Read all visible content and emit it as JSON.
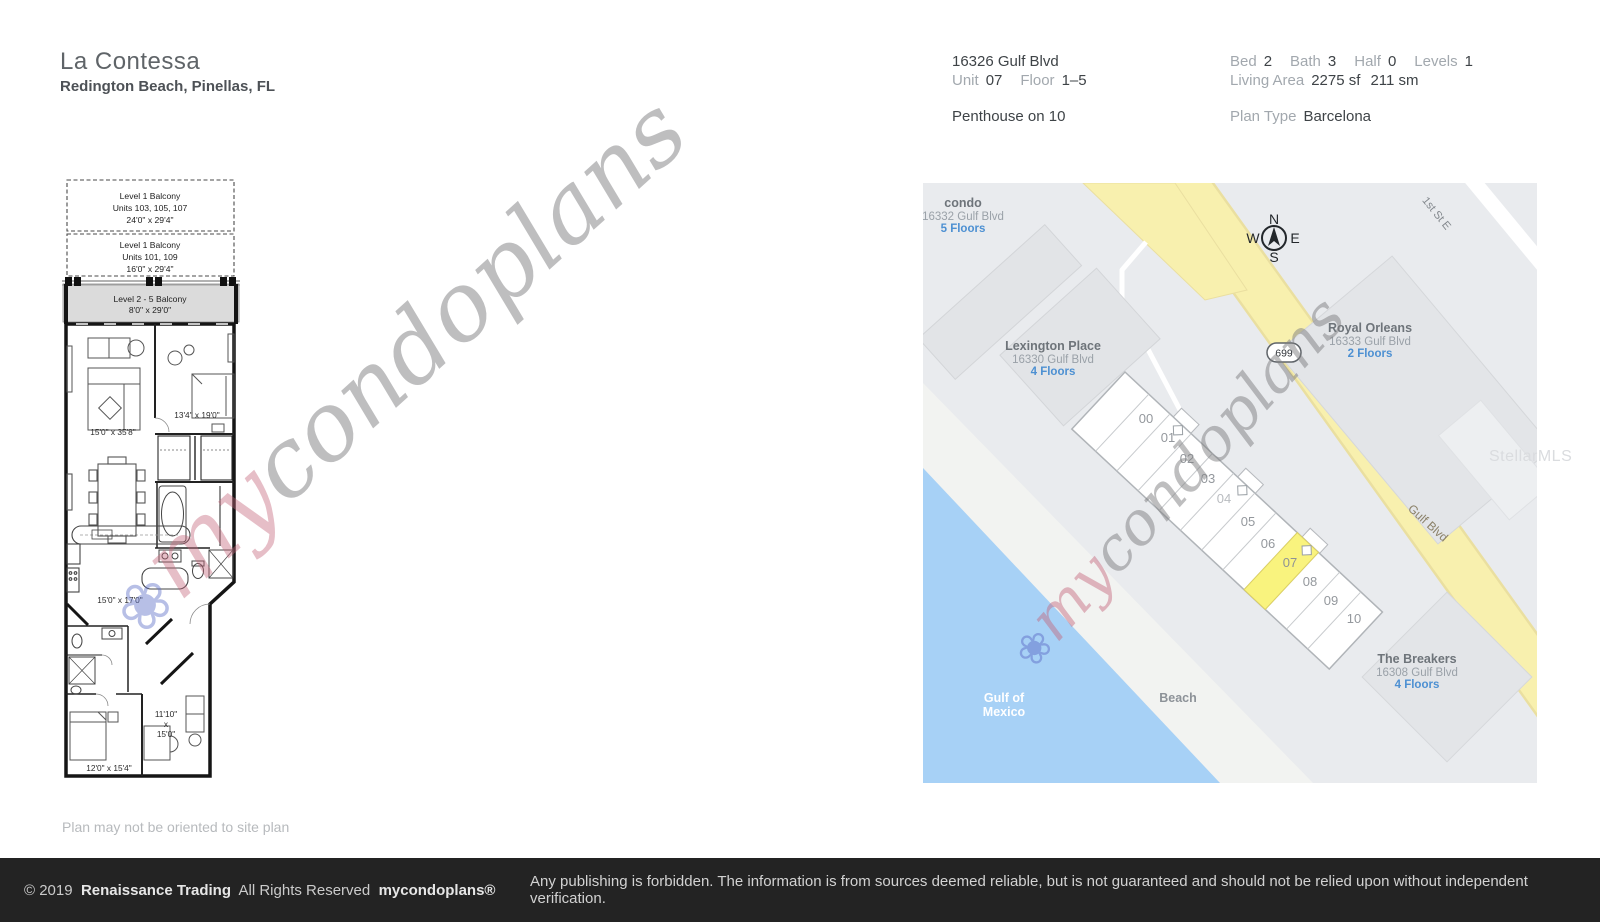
{
  "header": {
    "title": "La Contessa",
    "subtitle": "Redington Beach, Pinellas, FL",
    "address": "16326 Gulf Blvd",
    "unit_label": "Unit",
    "unit": "07",
    "floor_label": "Floor",
    "floor": "1–5",
    "penthouse": "Penthouse on 10",
    "bed_label": "Bed",
    "bed": "2",
    "bath_label": "Bath",
    "bath": "3",
    "half_label": "Half",
    "half": "0",
    "levels_label": "Levels",
    "levels": "1",
    "living_area_label": "Living Area",
    "living_area_sf": "2275 sf",
    "living_area_sm": "211 sm",
    "plan_type_label": "Plan Type",
    "plan_type": "Barcelona"
  },
  "floorplan": {
    "balcony1": {
      "l1": "Level 1 Balcony",
      "l2": "Units 103, 105, 107",
      "l3": "24'0\" x 29'4\""
    },
    "balcony2": {
      "l1": "Level 1 Balcony",
      "l2": "Units 101, 109",
      "l3": "16'0\" x 29'4\""
    },
    "balcony25": {
      "l1": "Level 2 - 5 Balcony",
      "l2": "8'0\" x 29'0\""
    },
    "living": "15'0\" x 35'8\"",
    "master": "13'4\" x 19'0\"",
    "kitchen": "15'0\" x 17'0\"",
    "den": [
      "11'10\"",
      "x",
      "15'0\""
    ],
    "bed2": "12'0\" x 15'4\"",
    "note": "Plan may not be oriented to site plan"
  },
  "map": {
    "buildings": [
      {
        "name": "condo",
        "address": "16332 Gulf Blvd",
        "floors": "5 Floors"
      },
      {
        "name": "Lexington Place",
        "address": "16330 Gulf Blvd",
        "floors": "4 Floors"
      },
      {
        "name": "Royal Orleans",
        "address": "16333 Gulf Blvd",
        "floors": "2 Floors"
      },
      {
        "name": "The Breakers",
        "address": "16308 Gulf Blvd",
        "floors": "4 Floors"
      }
    ],
    "roads": {
      "highway": "Gulf Blvd",
      "route_badge": "699",
      "street": "1st St E"
    },
    "areas": {
      "water1": "Gulf of",
      "water2": "Mexico",
      "beach": "Beach"
    },
    "compass": {
      "n": "N",
      "w": "W",
      "e": "E",
      "s": "S"
    },
    "units": [
      "00",
      "01",
      "02",
      "03",
      "04",
      "05",
      "06",
      "07",
      "08",
      "09",
      "10"
    ],
    "highlighted_unit": "07",
    "colors": {
      "highlight": "#f9f37e",
      "road_yellow": "#f8f0ae",
      "water": "#a7d1f6",
      "floors_link": "#4d90d2"
    }
  },
  "watermark": {
    "flower": "❀",
    "brand_prefix": "my",
    "brand_suffix": "condoplans",
    "mls": "StellarMLS"
  },
  "footer": {
    "copyright": "© 2019",
    "company": "Renaissance Trading",
    "rights": "All Rights Reserved",
    "brand": "mycondoplans®",
    "disclaimer": "Any publishing is forbidden.  The information is from sources deemed reliable, but is not guaranteed and should not be relied upon without independent verification."
  }
}
